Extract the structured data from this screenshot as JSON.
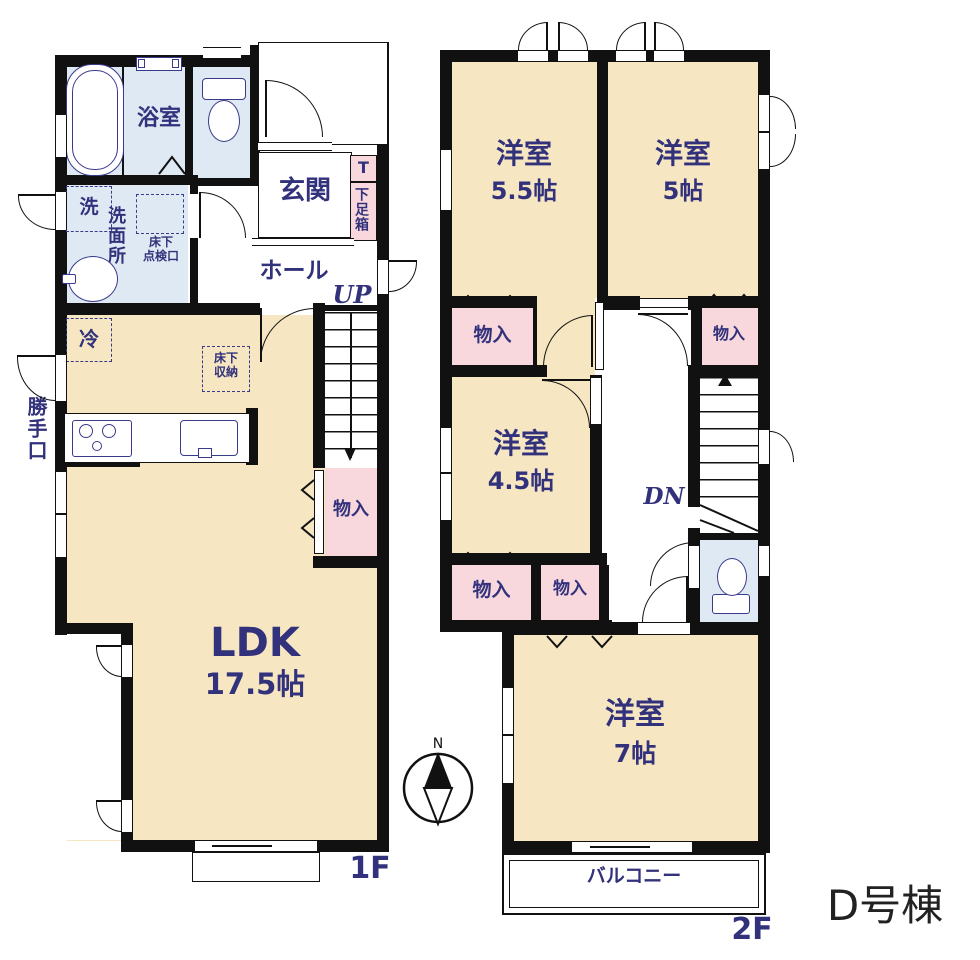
{
  "building": {
    "label": "D号棟"
  },
  "compass": {
    "north": "N"
  },
  "colors": {
    "wall": "#111111",
    "room_floor": "#f6e6c1",
    "wet_area": "#dfe9f4",
    "closet": "#f8d8dd",
    "text_navy": "#32327c",
    "background": "#ffffff"
  },
  "floor1": {
    "label": "1F",
    "rooms": {
      "bath": "浴室",
      "washroom_vertical": "洗面所",
      "washer": "洗",
      "underfloor_hatch_line1": "床下",
      "underfloor_hatch_line2": "点検口",
      "entrance": "玄関",
      "shoe_box_top": "T",
      "shoe_box": "下足箱",
      "hall": "ホール",
      "stairs_up": "UP",
      "fridge": "冷",
      "underfloor_storage_line1": "床下",
      "underfloor_storage_line2": "収納",
      "back_door": "勝手口",
      "closet": "物入",
      "ldk_name": "LDK",
      "ldk_size": "17.5帖"
    }
  },
  "floor2": {
    "label": "2F",
    "rooms": {
      "bedroom1_name": "洋室",
      "bedroom1_size": "5.5帖",
      "bedroom2_name": "洋室",
      "bedroom2_size": "5帖",
      "bedroom3_name": "洋室",
      "bedroom3_size": "4.5帖",
      "bedroom4_name": "洋室",
      "bedroom4_size": "7帖",
      "closet_top_left": "物入",
      "closet_top_right": "物入",
      "closet_bottom_left": "物入",
      "closet_bottom_mid": "物入",
      "stairs_down": "DN",
      "balcony": "バルコニー"
    }
  }
}
